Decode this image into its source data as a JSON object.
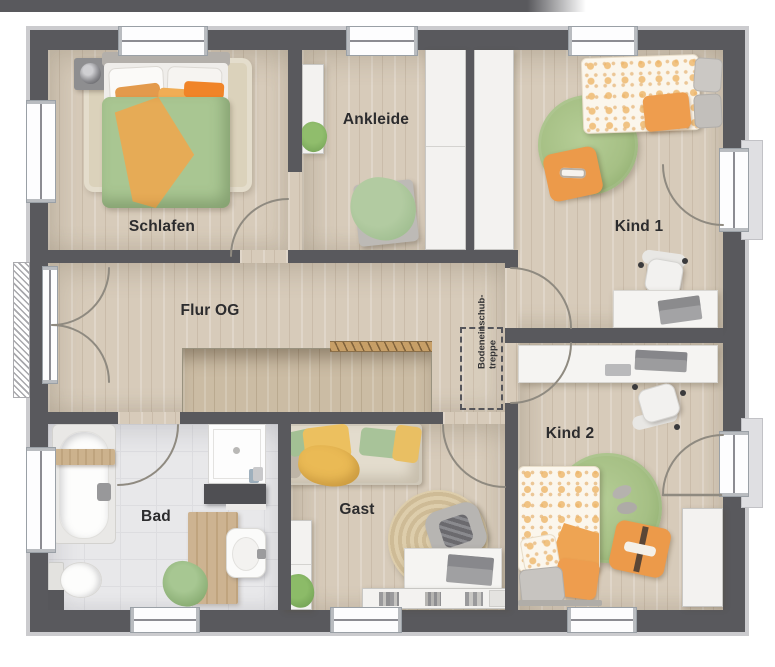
{
  "rooms": {
    "schlafen": "Schlafen",
    "ankleide": "Ankleide",
    "kind1": "Kind 1",
    "flur": "Flur OG",
    "bad": "Bad",
    "gast": "Gast",
    "kind2": "Kind 2"
  },
  "annotations": {
    "attic_ladder": {
      "line1": "Bodeneinschub-",
      "line2": "treppe"
    }
  },
  "colors": {
    "wall": "#59595d",
    "wall_edge": "#cbcbce",
    "floor_wood": "#d7cbba",
    "floor_tile": "#e8e8ea",
    "stair_void": "#cbbca4",
    "railing": "#c79f67",
    "label_text": "#2c2c2e",
    "accent_orange": "#ec9a4a",
    "accent_green": "#a9c592",
    "accent_yellow": "#e9bf63"
  }
}
